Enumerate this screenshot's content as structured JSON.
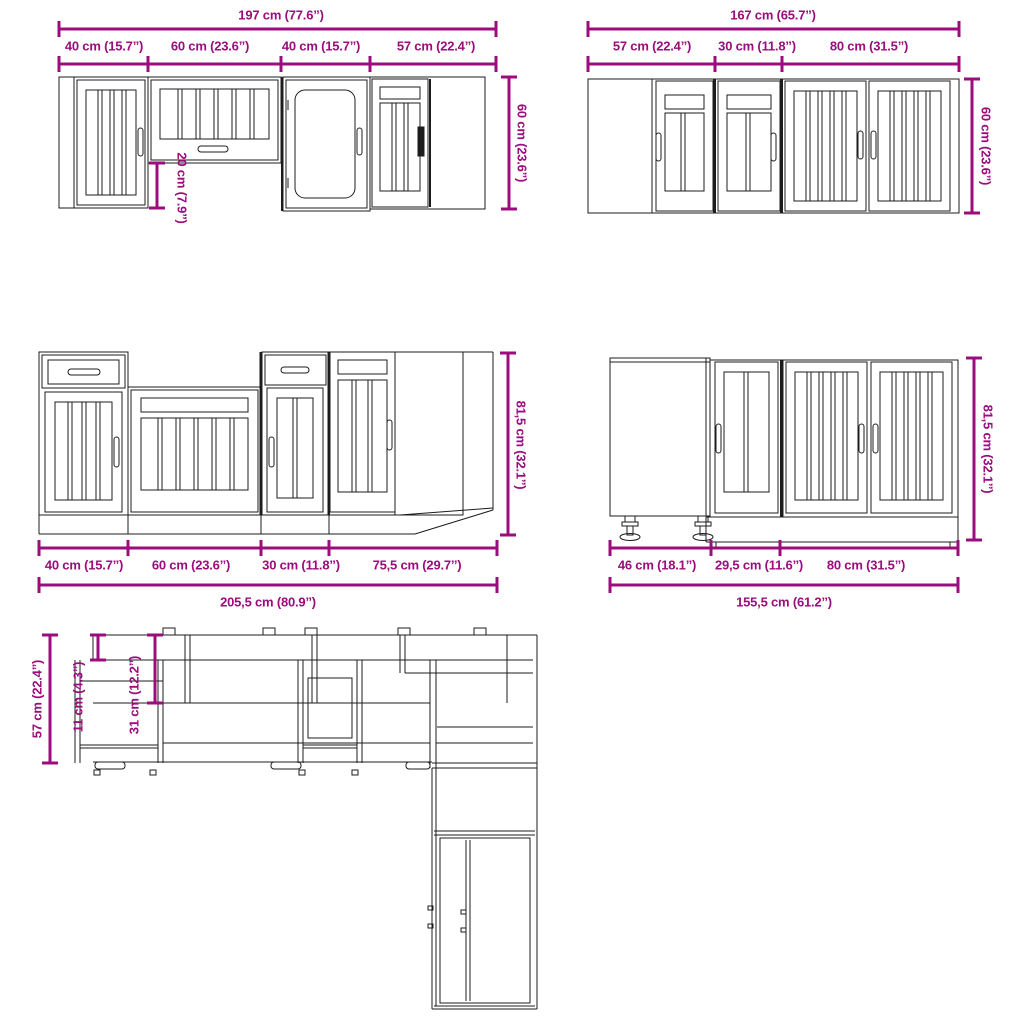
{
  "colors": {
    "dimension": "#9b0c7c",
    "line": "#1c1c1c",
    "background": "#ffffff"
  },
  "groups": {
    "wall_run_a": {
      "total": "197 cm (77.6’’)",
      "segments": [
        "40 cm (15.7’’)",
        "60 cm (23.6’’)",
        "40 cm (15.7’’)",
        "57 cm (22.4’’)"
      ],
      "height": "60 cm (23.6’’)",
      "hob_gap": "20 cm (7.9’’)"
    },
    "wall_run_b": {
      "total": "167 cm (65.7’’)",
      "segments": [
        "57 cm (22.4’’)",
        "30 cm (11.8’’)",
        "80 cm (31.5’’)"
      ],
      "height": "60 cm (23.6’’)"
    },
    "base_run_a": {
      "total": "205,5 cm (80.9’’)",
      "segments": [
        "40 cm (15.7’’)",
        "60 cm (23.6’’)",
        "30 cm (11.8’’)",
        "75,5 cm (29.7’’)"
      ],
      "height": "81,5 cm (32.1’’)"
    },
    "base_run_b": {
      "total": "155,5 cm (61.2’’)",
      "segments": [
        "46 cm (18.1’’)",
        "29,5 cm (11.6’’)",
        "80 cm (31.5’’)"
      ],
      "height": "81,5 cm (32.1’’)"
    },
    "plan_view": {
      "counter_depth": "57 cm (22.4’’)",
      "top_depth": "11 cm (4.3’’)",
      "wall_cabinet_depth": "31 cm (12.2’’)"
    }
  }
}
